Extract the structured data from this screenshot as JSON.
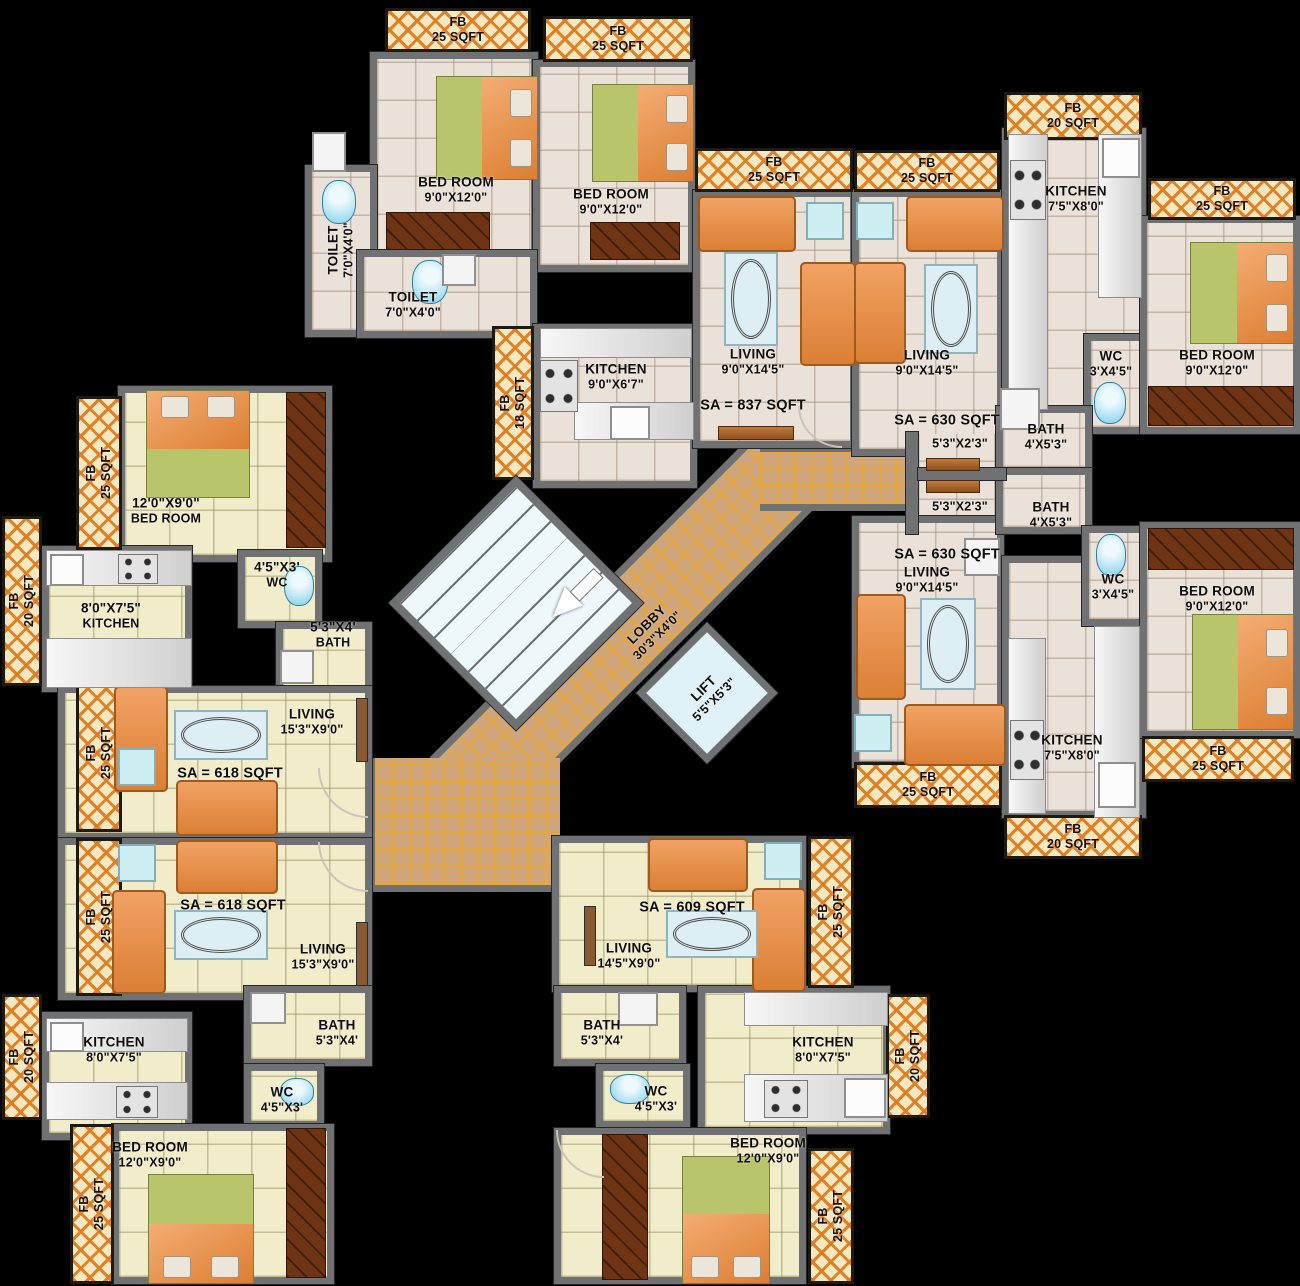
{
  "title": "Residential Building Typical Floor Plan",
  "colors": {
    "background": "#000000",
    "wall": "#6f7173",
    "floor_warm": "#eae1d8",
    "floor_pale": "#f1ecca",
    "fb_cream": "#f3e8c2",
    "fb_orange": "#de7c1e",
    "lobby_tan": "#cfa67c",
    "lobby_grid_gold": "#e6a73a",
    "lift_blue": "#e0f1f8",
    "stair_blue": "#eef8fb",
    "sofa_orange": "#e8914e",
    "bed_green": "#b9c56b",
    "bed_sheet_orange": "#e89055",
    "wardrobe_brown": "#6e3413",
    "fixture_blue": "#7fd0ec",
    "label_text": "#0e0d0c"
  },
  "sa_labels": [
    "SA = 837 SQFT",
    "SA = 630 SQFT",
    "SA = 630 SQFT",
    "SA = 618 SQFT",
    "SA = 618 SQFT",
    "SA = 609 SQFT"
  ],
  "lobby": {
    "name": "LOBBY",
    "dims": "30'3\"X4'0\""
  },
  "lift": {
    "name": "LIFT",
    "dims": "5'5\"X5'3\""
  },
  "passage": {
    "dims": "5'3\"X2'3\""
  },
  "rooms": {
    "bedroom_a1": {
      "name": "BED ROOM",
      "dims": "9'0\"X12'0\""
    },
    "bedroom_a2": {
      "name": "BED ROOM",
      "dims": "9'0\"X12'0\""
    },
    "toilet_a1": {
      "name": "TOILET",
      "dims": "7'0\"X4'0\""
    },
    "toilet_a2": {
      "name": "TOILET",
      "dims": "7'0\"X4'0\""
    },
    "kitchen_a": {
      "name": "KITCHEN",
      "dims": "9'0\"X6'7\""
    },
    "living_a": {
      "name": "LIVING",
      "dims": "9'0\"X14'5\""
    },
    "living_b": {
      "name": "LIVING",
      "dims": "9'0\"X14'5\""
    },
    "kitchen_b": {
      "name": "KITCHEN",
      "dims": "7'5\"X8'0\""
    },
    "wc_b": {
      "name": "WC",
      "dims": "3'X4'5\""
    },
    "bath_b": {
      "name": "BATH",
      "dims": "4'X5'3\""
    },
    "bedroom_b": {
      "name": "BED ROOM",
      "dims": "9'0\"X12'0\""
    },
    "living_c": {
      "name": "LIVING",
      "dims": "9'0\"X14'5\""
    },
    "bath_c": {
      "name": "BATH",
      "dims": "4'X5'3\""
    },
    "wc_c": {
      "name": "WC",
      "dims": "3'X4'5\""
    },
    "bedroom_c": {
      "name": "BED ROOM",
      "dims": "9'0\"X12'0\""
    },
    "kitchen_c": {
      "name": "KITCHEN",
      "dims": "7'5\"X8'0\""
    },
    "bedroom_f": {
      "name": "BED ROOM",
      "dims": "12'0\"X9'0\""
    },
    "wc_f": {
      "name": "WC",
      "dims": "4'5\"X3'"
    },
    "kitchen_f": {
      "name": "KITCHEN",
      "dims": "8'0\"X7'5\""
    },
    "bath_f": {
      "name": "BATH",
      "dims": "5'3\"X4'"
    },
    "living_f": {
      "name": "LIVING",
      "dims": "15'3\"X9'0\""
    },
    "living_e": {
      "name": "LIVING",
      "dims": "15'3\"X9'0\""
    },
    "kitchen_e": {
      "name": "KITCHEN",
      "dims": "8'0\"X7'5\""
    },
    "bath_e": {
      "name": "BATH",
      "dims": "5'3\"X4'"
    },
    "wc_e": {
      "name": "WC",
      "dims": "4'5\"X3'"
    },
    "bedroom_e": {
      "name": "BED ROOM",
      "dims": "12'0\"X9'0\""
    },
    "living_d": {
      "name": "LIVING",
      "dims": "14'5\"X9'0\""
    },
    "bath_d": {
      "name": "BATH",
      "dims": "5'3\"X4'"
    },
    "wc_d": {
      "name": "WC",
      "dims": "4'5\"X3'"
    },
    "kitchen_d": {
      "name": "KITCHEN",
      "dims": "8'0\"X7'5\""
    },
    "bedroom_d": {
      "name": "BED ROOM",
      "dims": "12'0\"X9'0\""
    }
  },
  "flower_beds": [
    {
      "label": "FB",
      "size": "25 SQFT"
    },
    {
      "label": "FB",
      "size": "25 SQFT"
    },
    {
      "label": "FB",
      "size": "25 SQFT"
    },
    {
      "label": "FB",
      "size": "25 SQFT"
    },
    {
      "label": "FB",
      "size": "20 SQFT"
    },
    {
      "label": "FB",
      "size": "25 SQFT"
    },
    {
      "label": "FB",
      "size": "18 SQFT"
    },
    {
      "label": "FB",
      "size": "25 SQFT"
    },
    {
      "label": "FB",
      "size": "20 SQFT"
    },
    {
      "label": "FB",
      "size": "25 SQFT"
    },
    {
      "label": "FB",
      "size": "25 SQFT"
    },
    {
      "label": "FB",
      "size": "20 SQFT"
    },
    {
      "label": "FB",
      "size": "25 SQFT"
    },
    {
      "label": "FB",
      "size": "25 SQFT"
    },
    {
      "label": "FB",
      "size": "25 SQFT"
    },
    {
      "label": "FB",
      "size": "20 SQFT"
    },
    {
      "label": "FB",
      "size": "25 SQFT"
    },
    {
      "label": "FB",
      "size": "20 SQFT"
    },
    {
      "label": "FB",
      "size": "25 SQFT"
    }
  ],
  "legend": {
    "icons": [
      "double-bed",
      "wardrobe",
      "sofa",
      "oval-rug",
      "side-table",
      "tv-unit",
      "gas-stove",
      "kitchen-sink",
      "wash-basin",
      "toilet-pan",
      "staircase",
      "direction-arrow",
      "door-swing",
      "flower-bed-hatch",
      "lobby-tiles"
    ]
  }
}
